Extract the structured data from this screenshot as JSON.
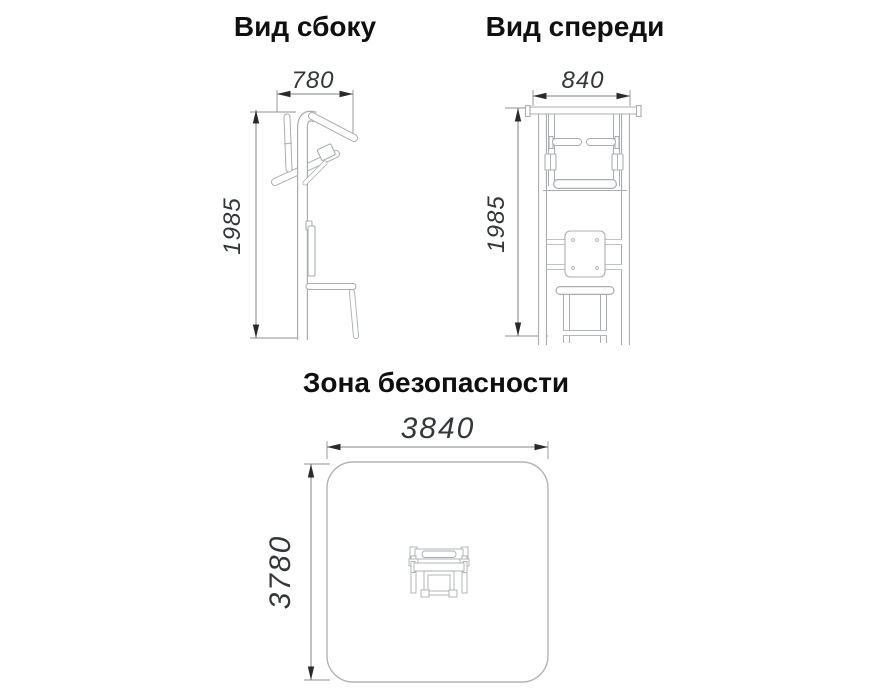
{
  "views": {
    "side": {
      "title": "Вид сбоку",
      "width": "780",
      "height": "1985"
    },
    "front": {
      "title": "Вид спереди",
      "width": "840",
      "height": "1985"
    },
    "safety": {
      "title": "Зона безопасности",
      "width": "3840",
      "height": "3780"
    }
  },
  "colors": {
    "background": "#ffffff",
    "drawing_line": "#a9adb0",
    "dimension_line": "#7d8184",
    "dimension_text": "#33373a",
    "arrow": "#2a2a2a",
    "title_text": "#101010"
  },
  "icons": {
    "apparatus_top_view": "pullup-dip-station-top-view"
  }
}
